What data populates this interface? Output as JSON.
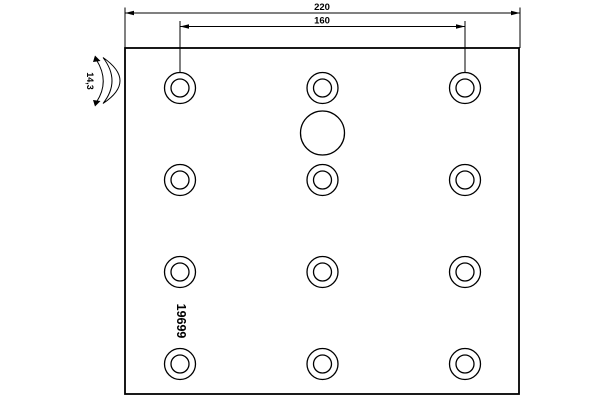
{
  "drawing": {
    "type": "brake-lining-technical-drawing",
    "colors": {
      "background": "#ffffff",
      "line": "#000000"
    },
    "dimensions": [
      {
        "id": "overall-width",
        "label": "220"
      },
      {
        "id": "hole-span",
        "label": "160"
      }
    ],
    "labels": {
      "part_number": "19699",
      "thickness": "14,3"
    },
    "drawing_data": {
      "plate": {
        "x": 125,
        "y": 48,
        "width": 394,
        "height": 346
      },
      "holes": {
        "columns_x": [
          180,
          322.5,
          465
        ],
        "rows_y": [
          88,
          180,
          272,
          364
        ],
        "outer_radius": 15.5,
        "inner_radius": 9
      },
      "hatched_hole": {
        "cx": 322.5,
        "cy": 133,
        "radius": 22
      }
    }
  }
}
